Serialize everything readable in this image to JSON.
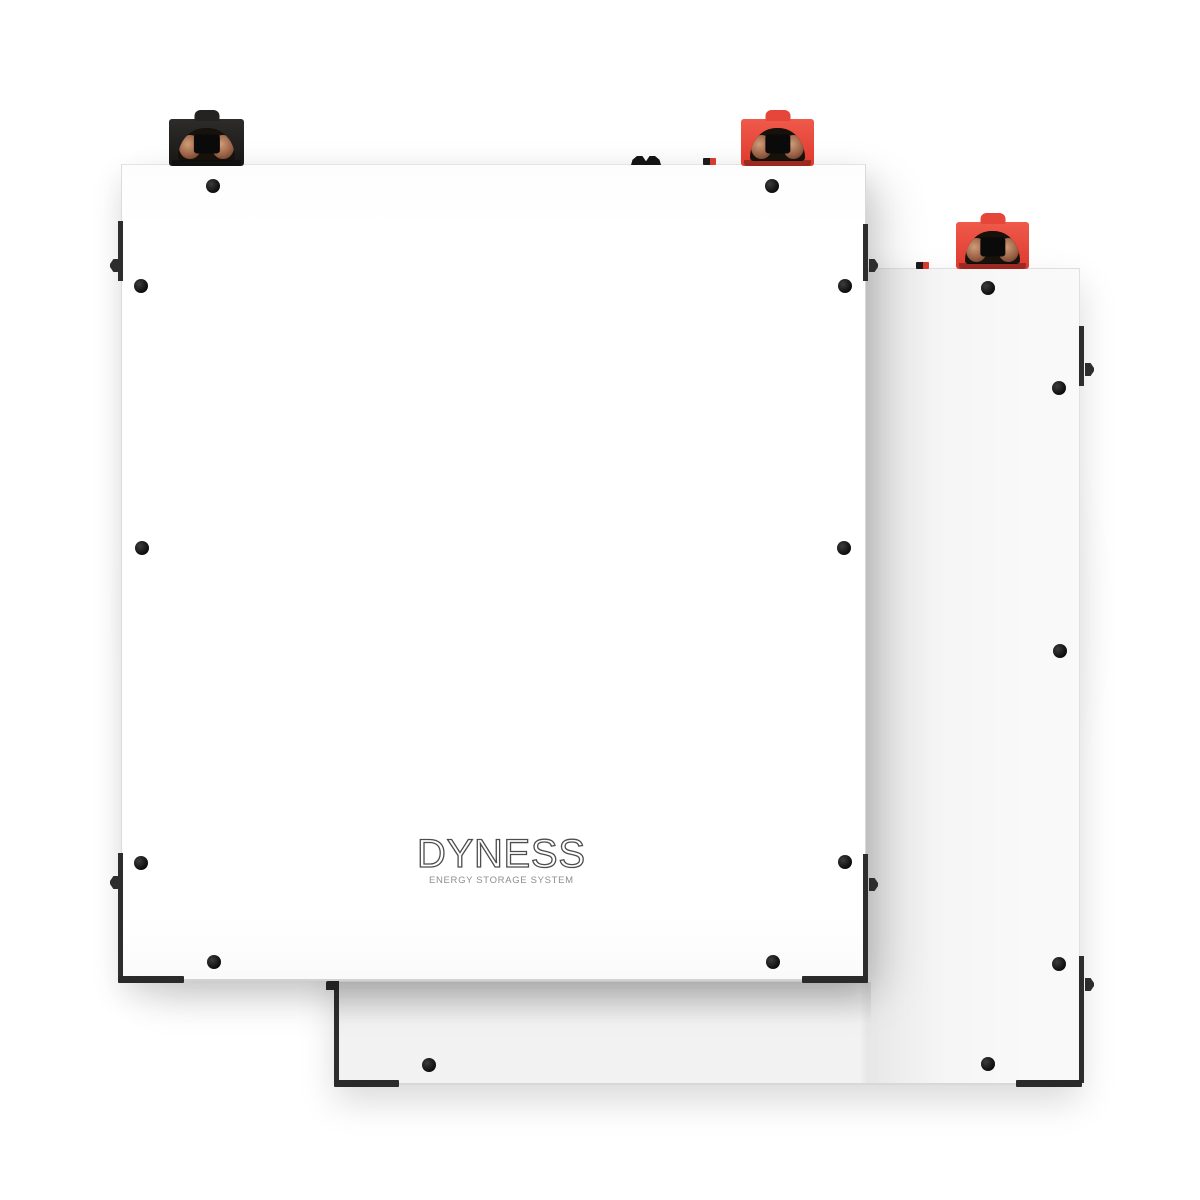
{
  "scene": {
    "description": "Two white Dyness wall-mounted battery energy storage modules overlapping, front module with black and red power terminals on top, rear module with red terminal, black mounting screws and dark mounting brackets"
  },
  "brand": {
    "name": "DYNESS",
    "tagline": "ENERGY STORAGE SYSTEM"
  },
  "colors": {
    "background": "#ffffff",
    "halo_gray": "#e8e8e8",
    "panel_white": "#ffffff",
    "back_panel_gray": "#f2f2f2",
    "terminal_red": "#e6453a",
    "terminal_black": "#242322",
    "copper_contact": "#b5795a",
    "screw_black": "#0b0b0b",
    "bracket_dark": "#2e2d2d",
    "logo_stroke": "#4d4d4d",
    "tagline_gray": "#8f8f8f"
  },
  "front_unit": {
    "terminals": [
      "black",
      "red"
    ],
    "screw_count": 10
  },
  "back_unit": {
    "terminals": [
      "red"
    ],
    "screw_count": 6
  }
}
